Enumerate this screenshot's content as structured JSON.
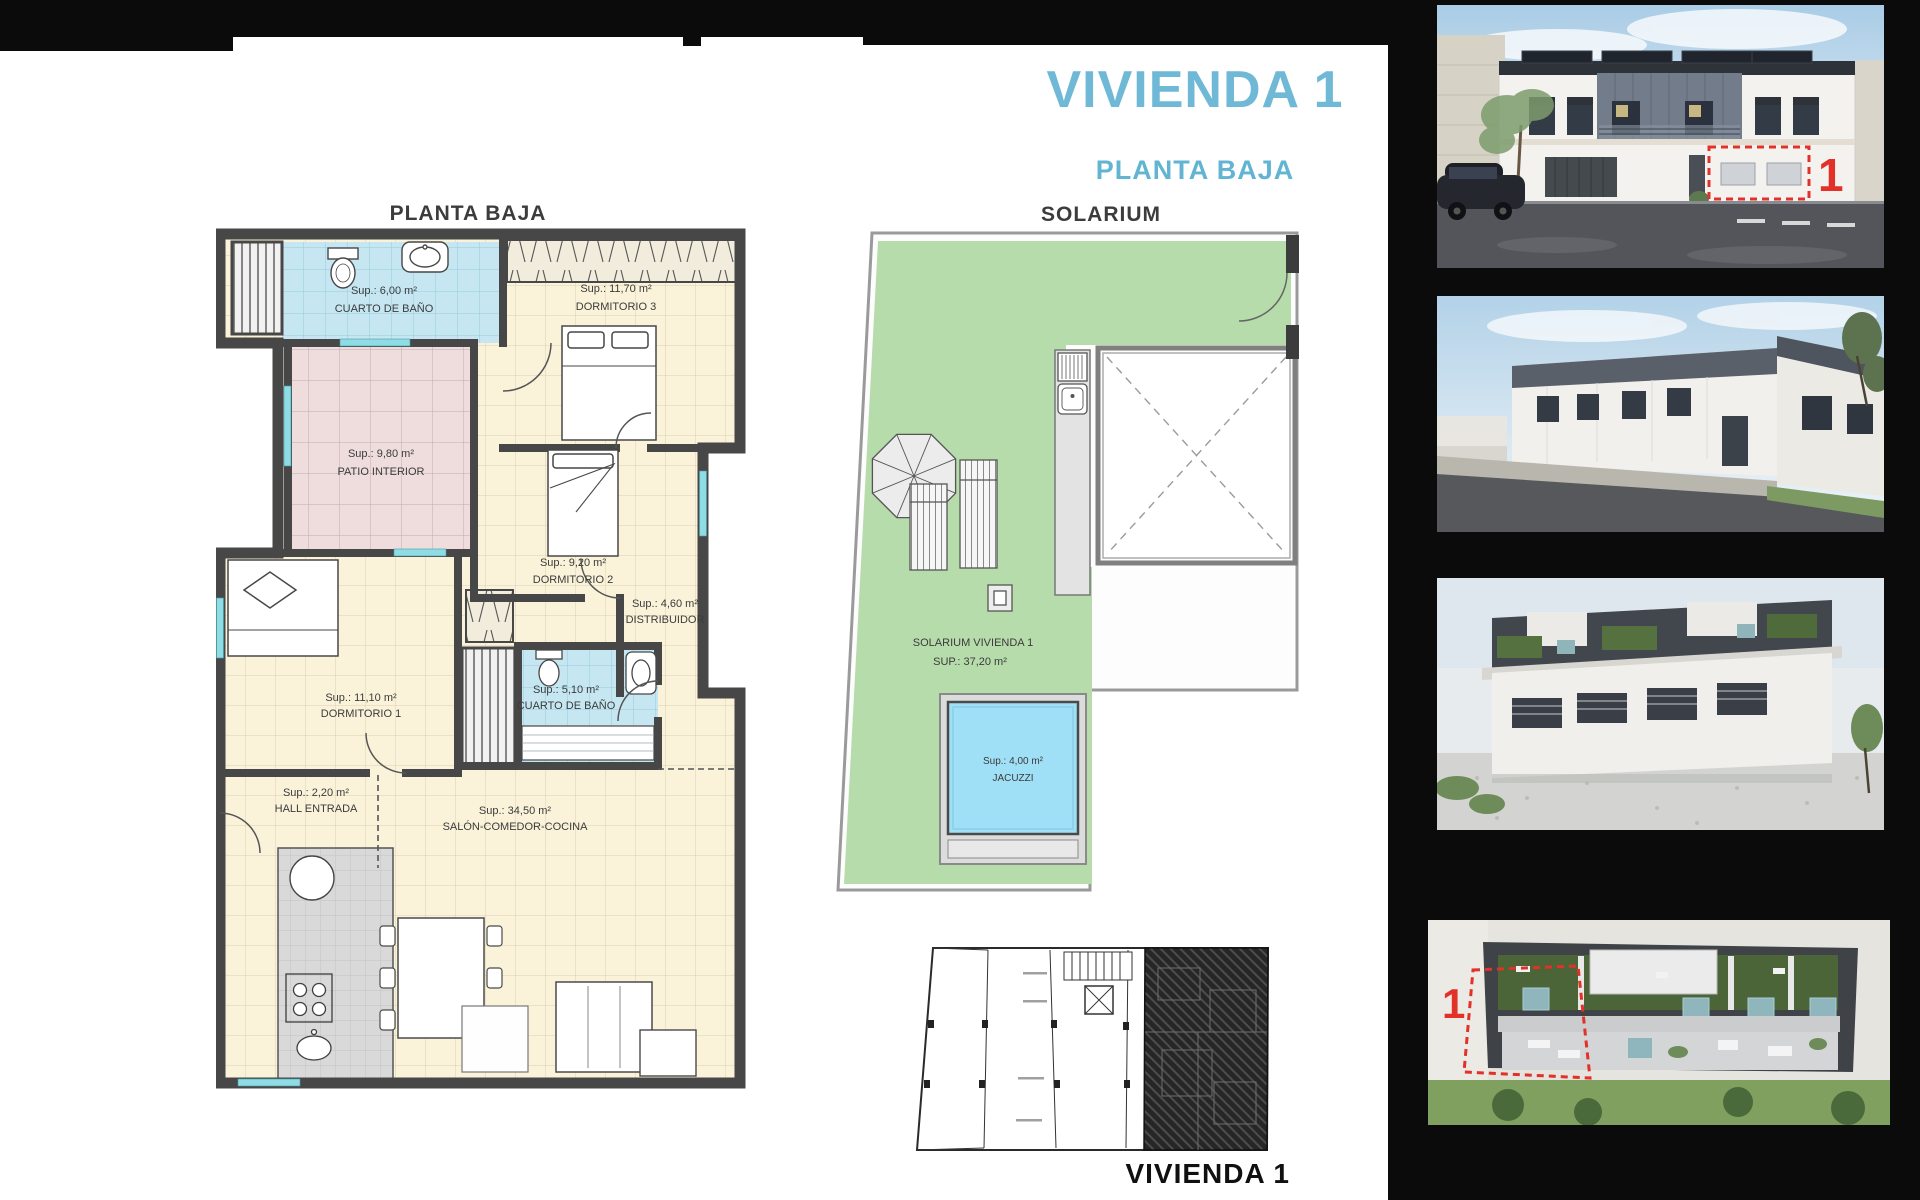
{
  "page": {
    "title": "VIVIENDA 1",
    "subtitle": "PLANTA BAJA"
  },
  "floorplan": {
    "title": "PLANTA BAJA",
    "rooms": [
      {
        "id": "cuarto-de-bano-1",
        "area": "Sup.: 6,00 m²",
        "name": "CUARTO DE BAÑO"
      },
      {
        "id": "dormitorio-3",
        "area": "Sup.: 11,70 m²",
        "name": "DORMITORIO 3"
      },
      {
        "id": "patio-interior",
        "area": "Sup.: 9,80 m²",
        "name": "PATIO INTERIOR"
      },
      {
        "id": "dormitorio-2",
        "area": "Sup.: 9,20 m²",
        "name": "DORMITORIO 2"
      },
      {
        "id": "distribuidor",
        "area": "Sup.: 4,60 m²",
        "name": "DISTRIBUIDOR"
      },
      {
        "id": "dormitorio-1",
        "area": "Sup.: 11,10 m²",
        "name": "DORMITORIO 1"
      },
      {
        "id": "cuarto-de-bano-2",
        "area": "Sup.: 5,10 m²",
        "name": "CUARTO DE BAÑO"
      },
      {
        "id": "hall-entrada",
        "area": "Sup.: 2,20 m²",
        "name": "HALL ENTRADA"
      },
      {
        "id": "salon-comedor-cocina",
        "area": "Sup.: 34,50 m²",
        "name": "SALÓN-COMEDOR-COCINA"
      }
    ]
  },
  "solarium": {
    "title": "SOLARIUM",
    "room_label": "SOLARIUM VIVIENDA  1",
    "room_area": "SUP.: 37,20 m²",
    "jacuzzi_area": "Sup.: 4,00 m²",
    "jacuzzi_name": "JACUZZI"
  },
  "keyplan": {
    "label": "VIVIENDA 1"
  },
  "photos": {
    "marker": "1"
  },
  "colors": {
    "accent_blue": "#6fb9d6",
    "wall_gray": "#474747",
    "room_cream": "#faf3da",
    "bath_blue": "#c6e7f2",
    "patio_pink": "#efdddd",
    "solarium_green": "#b7dcab",
    "jacuzzi_blue": "#9fe0f6",
    "marker_red": "#e23128"
  }
}
